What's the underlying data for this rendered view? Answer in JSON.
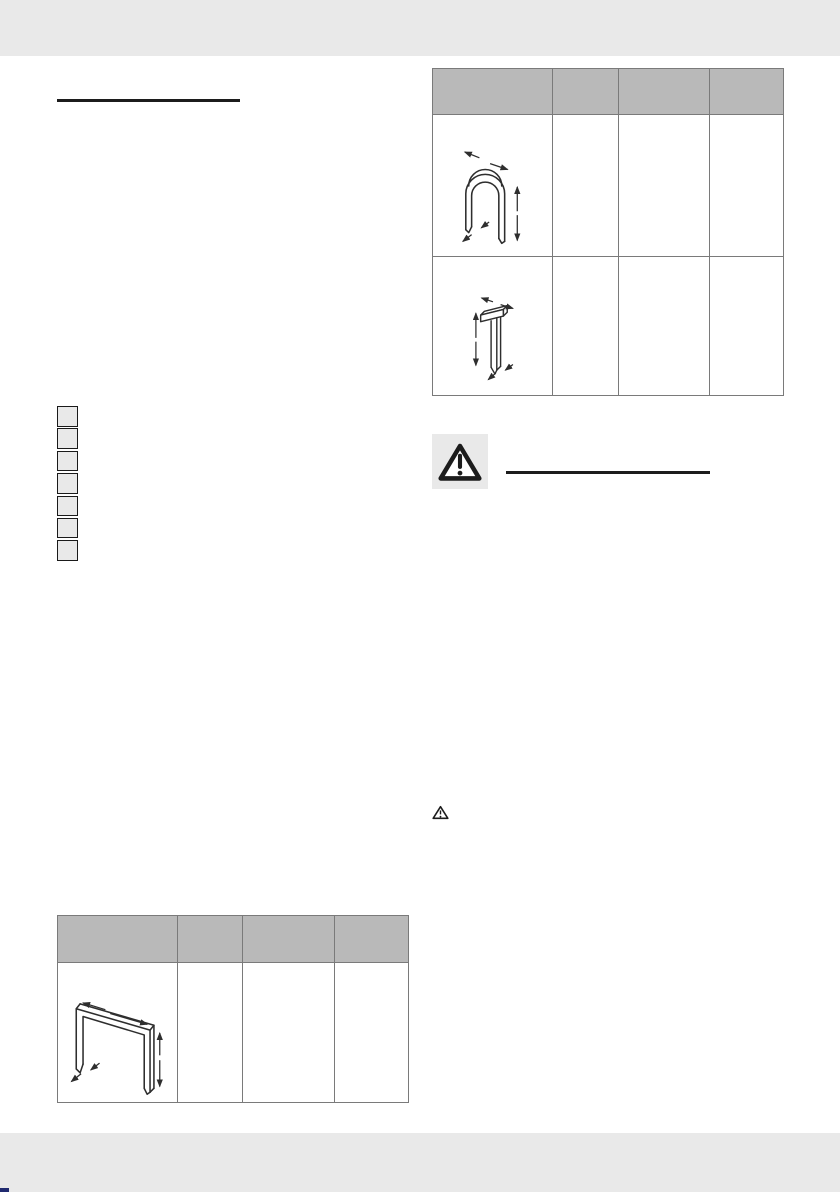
{
  "page": {
    "type": "instruction-manual-page",
    "width": 840,
    "height": 1192
  },
  "colors": {
    "page_bg": "#ffffff",
    "band": "#e9e9e9",
    "table_header_fill": "#b9b9b9",
    "table_border": "#7a7a7a",
    "ink": "#1c1c1c",
    "line_art": "#2e2e2e",
    "corner_mark": "#202a6f"
  },
  "left_section": {
    "heading": "",
    "step_markers": {
      "count": 7,
      "style": "empty-grey-box"
    }
  },
  "left_table": {
    "columns": [
      "",
      "",
      "",
      ""
    ],
    "rows": [
      {
        "icon": "wide-crown-staple-icon",
        "values": [
          "",
          "",
          ""
        ]
      }
    ]
  },
  "right_table": {
    "columns": [
      "",
      "",
      "",
      ""
    ],
    "rows": [
      {
        "icon": "narrow-crown-staple-icon",
        "values": [
          "",
          "",
          ""
        ]
      },
      {
        "icon": "t-pin-nail-icon",
        "values": [
          "",
          "",
          ""
        ]
      }
    ]
  },
  "warning_section": {
    "icon": "warning-triangle-icon",
    "heading": ""
  },
  "inline_note": {
    "icon": "warning-triangle-small-icon",
    "text": ""
  }
}
